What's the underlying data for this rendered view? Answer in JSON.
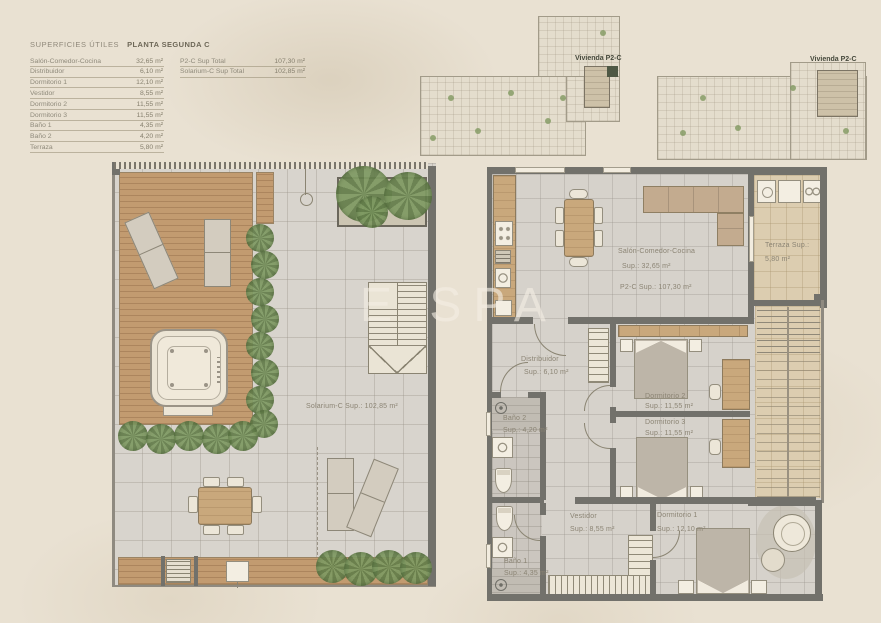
{
  "page": {
    "watermark": "E SPA"
  },
  "colors": {
    "background": "#e9e1d2",
    "wall": "#72716b",
    "deck_wood": "#c29b70",
    "furniture_wood": "#c9a87c",
    "plant_green": "#7f9a63",
    "highlight_green": "#4e5844",
    "tile_floor": "#d8d4cd",
    "terrace_floor": "#dccdb0"
  },
  "legend": {
    "title_prefix": "SUPERFICIES ÚTILES",
    "title_bold": "PLANTA SEGUNDA C",
    "rows": [
      {
        "label": "Salón-Comedor-Cocina",
        "value": "32,65 m²"
      },
      {
        "label": "Distribuidor",
        "value": "6,10 m²"
      },
      {
        "label": "Dormitorio 1",
        "value": "12,10 m²"
      },
      {
        "label": "Vestidor",
        "value": "8,55 m²"
      },
      {
        "label": "Dormitorio 2",
        "value": "11,55 m²"
      },
      {
        "label": "Dormitorio 3",
        "value": "11,55 m²"
      },
      {
        "label": "Baño 1",
        "value": "4,35 m²"
      },
      {
        "label": "Baño 2",
        "value": "4,20 m²"
      },
      {
        "label": "Terraza",
        "value": "5,80 m²"
      }
    ],
    "totals": [
      {
        "label": "P2-C Sup Total",
        "value": "107,30 m²"
      },
      {
        "label": "Solarium-C Sup Total",
        "value": "102,85 m²"
      }
    ]
  },
  "keyplans": [
    {
      "label": "Vivienda P2-C"
    },
    {
      "label": "Vivienda P2-C"
    }
  ],
  "solarium": {
    "area_label": "Solarium-C Sup.: 102,85 m²"
  },
  "apartment": {
    "rooms": {
      "salon": {
        "name": "Salón-Comedor-Cocina",
        "sup": "Sup.: 32,65 m²",
        "total": "P2-C Sup.: 107,30 m²"
      },
      "terraza": {
        "name": "Terraza Sup.:",
        "sup": "5,80 m²"
      },
      "distribuidor": {
        "name": "Distribuidor",
        "sup": "Sup.: 6,10 m²"
      },
      "dormitorio2": {
        "name": "Dormitorio 2",
        "sup": "Sup.: 11,55 m²"
      },
      "dormitorio3": {
        "name": "Dormitorio 3",
        "sup": "Sup.: 11,55 m²"
      },
      "bano2": {
        "name": "Baño 2",
        "sup": "Sup.: 4,20 m²"
      },
      "bano1": {
        "name": "Baño 1",
        "sup": "Sup.: 4,35 m²"
      },
      "vestidor": {
        "name": "Vestidor",
        "sup": "Sup.: 8,55 m²"
      },
      "dormitorio1": {
        "name": "Dormitorio 1",
        "sup": "Sup.: 12,10 m²"
      }
    }
  }
}
